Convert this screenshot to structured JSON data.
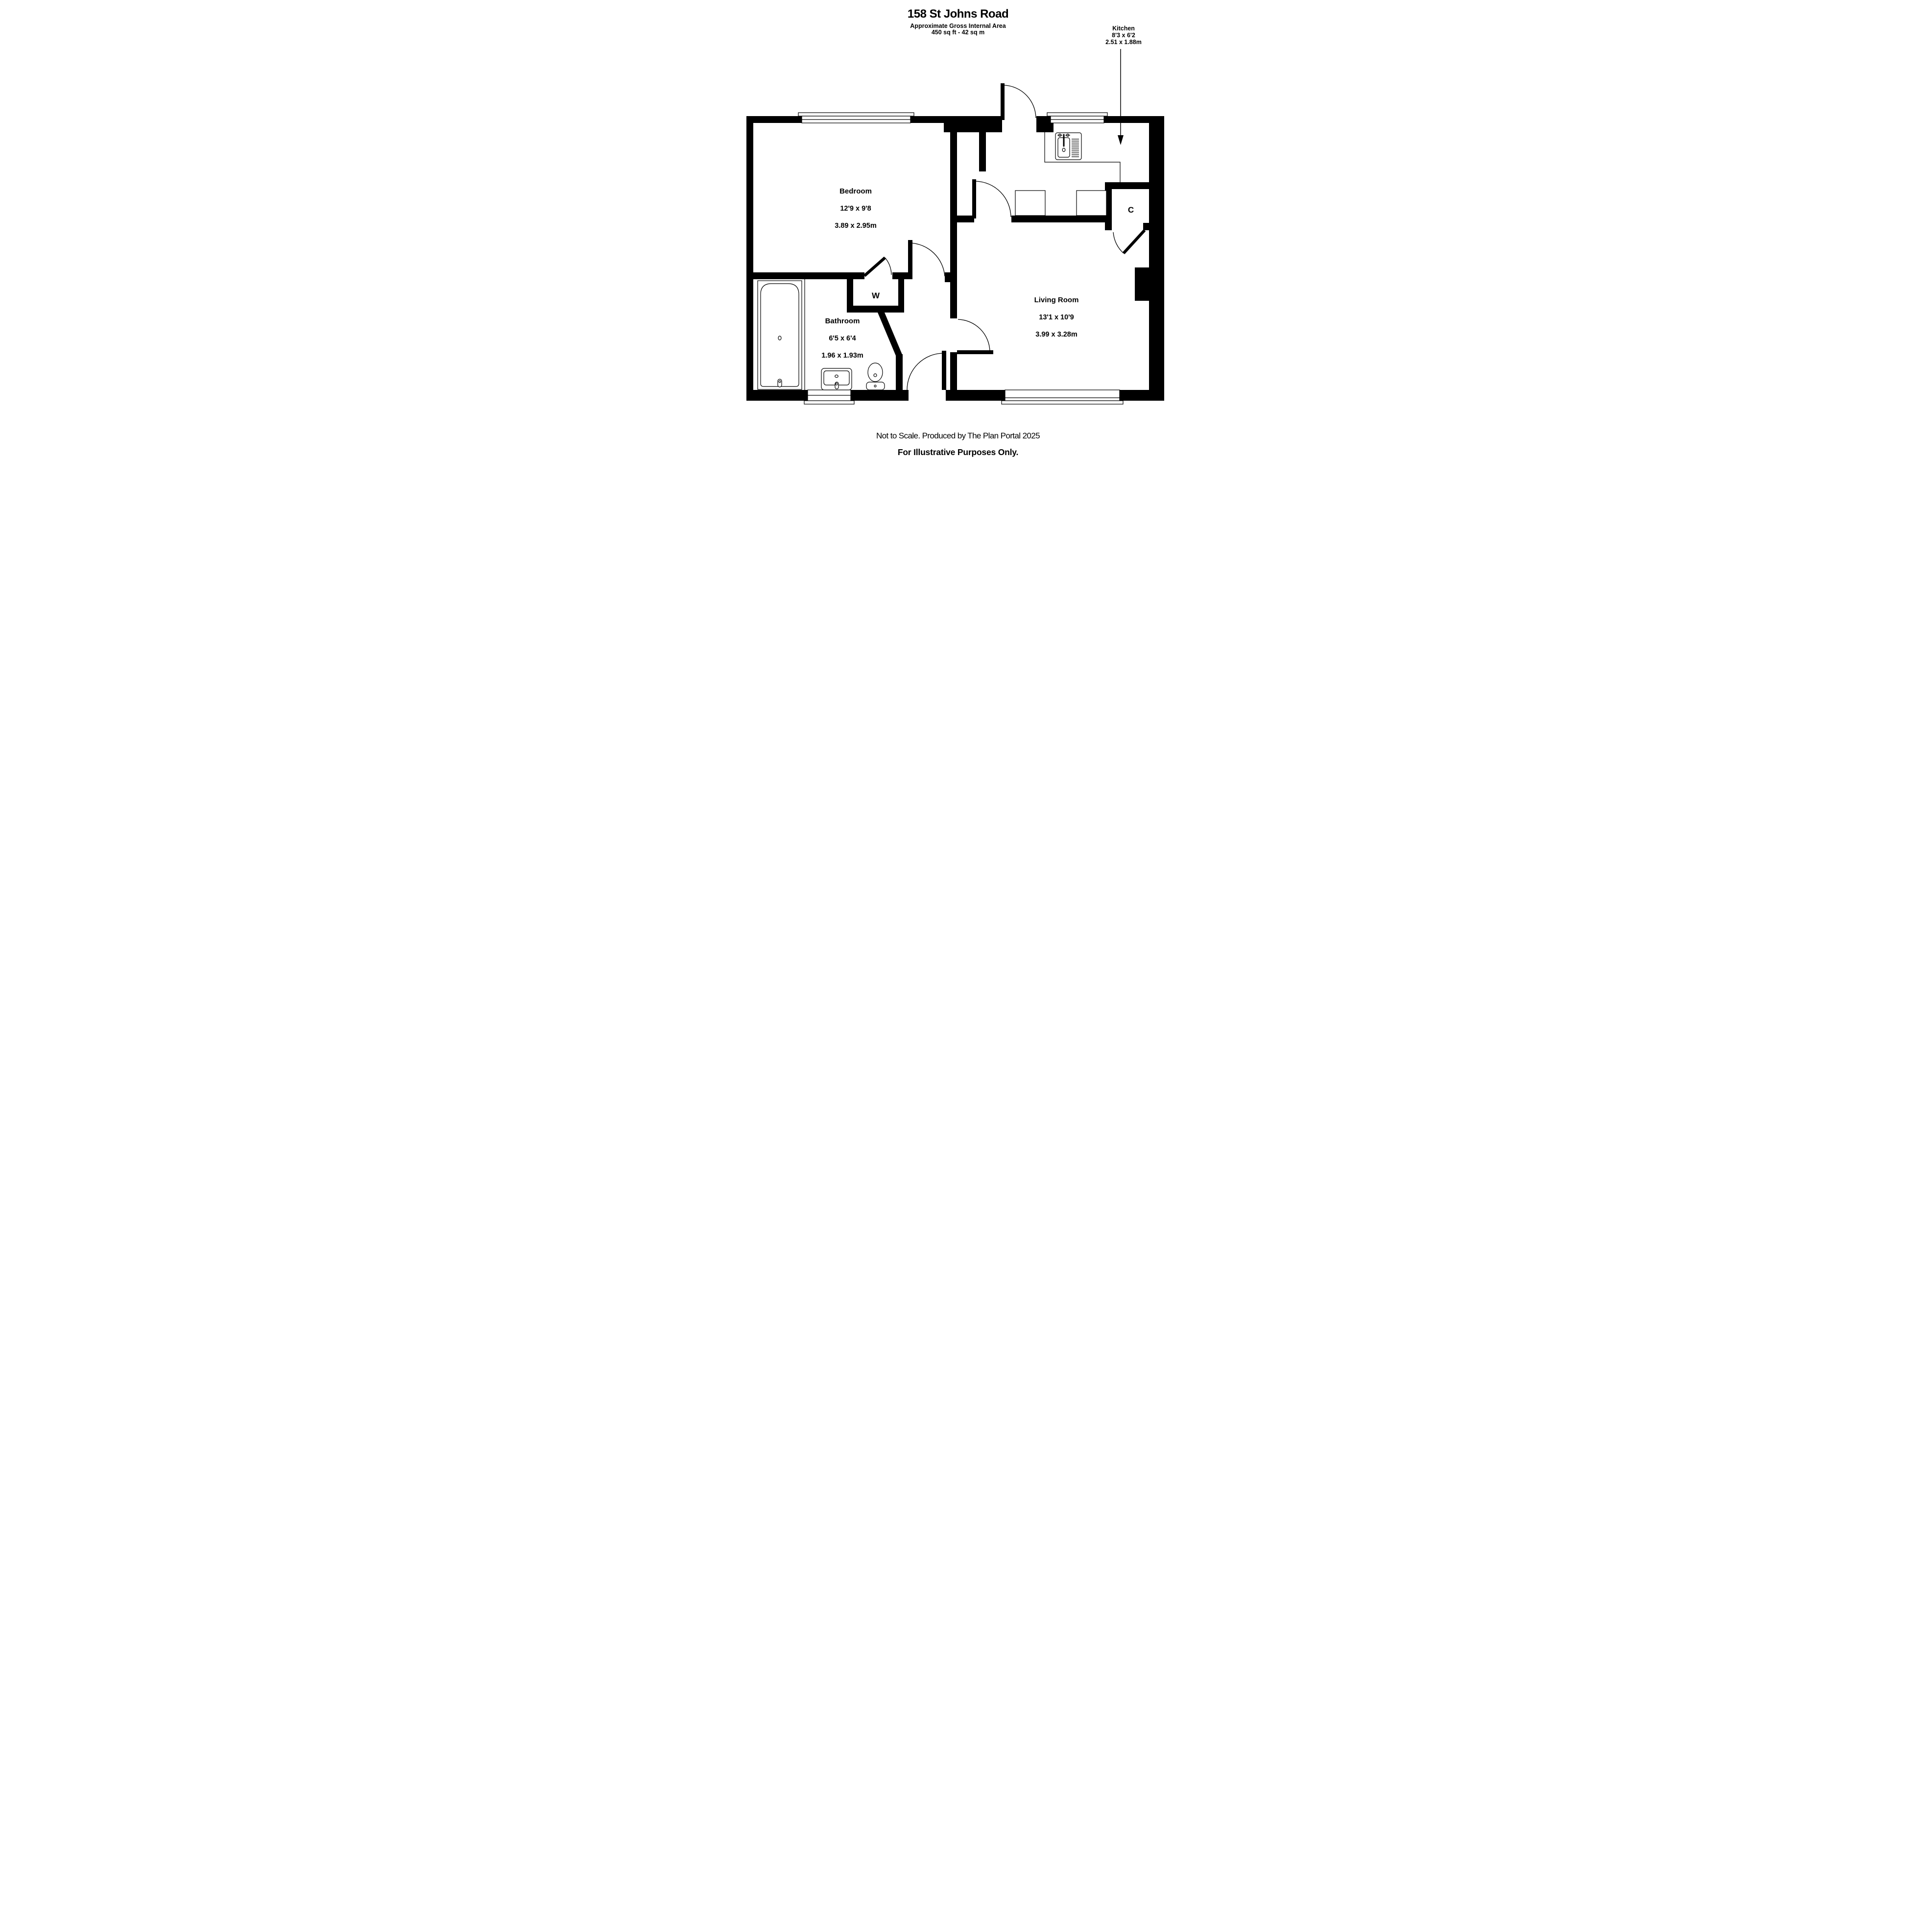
{
  "title": {
    "line1": "158 St Johns Road",
    "line2": "Approximate Gross Internal Area",
    "line3": "450 sq ft - 42 sq m"
  },
  "rooms": {
    "bedroom": {
      "name": "Bedroom",
      "imperial": "12'9 x 9'8",
      "metric": "3.89 x 2.95m"
    },
    "kitchen": {
      "name": "Kitchen",
      "imperial": "8'3 x 6'2",
      "metric": "2.51 x 1.88m"
    },
    "living_room": {
      "name": "Living Room",
      "imperial": "13'1 x 10'9",
      "metric": "3.99 x 3.28m"
    },
    "bathroom": {
      "name": "Bathroom",
      "imperial": "6'5 x 6'4",
      "metric": "1.96 x 1.93m"
    },
    "wardrobe": {
      "label": "W"
    },
    "cupboard": {
      "label": "C"
    }
  },
  "footer": {
    "line1": "Not to Scale. Produced by The Plan Portal 2025",
    "line2": "For Illustrative Purposes Only."
  },
  "icons": {
    "kitchen_pointer": "arrow-down-icon",
    "fixtures": [
      "bathtub-icon",
      "wash-basin-icon",
      "toilet-icon",
      "kitchen-sink-icon"
    ]
  },
  "colors": {
    "walls": "#000000",
    "background": "#ffffff",
    "text": "#000000"
  }
}
